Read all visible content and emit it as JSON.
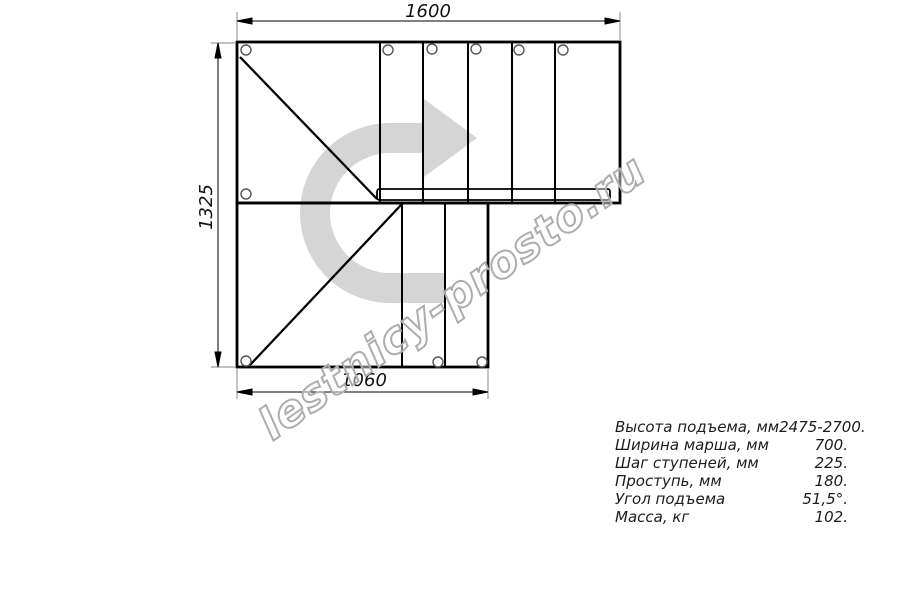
{
  "drawing": {
    "title_hint": "L-shaped staircase plan view",
    "dim_top": "1600",
    "dim_left": "1325",
    "dim_bottom": "1060",
    "watermark": "lestnicy-prosto.ru",
    "direction_arrow": "u-turn-arrow-pointing-right"
  },
  "specs": {
    "rows": [
      {
        "label": "Высота подъема, мм",
        "value": "2475-2700."
      },
      {
        "label": "Ширина марша, мм",
        "value": "700."
      },
      {
        "label": "Шаг ступеней, мм",
        "value": "225."
      },
      {
        "label": "Проступь, мм",
        "value": "180."
      },
      {
        "label": "Угол подъема",
        "value": "51,5°."
      },
      {
        "label": "Масса, кг",
        "value": "102."
      }
    ]
  },
  "colors": {
    "line": "#000000",
    "extension_line": "#9c9c9c",
    "circle_stroke": "#555555",
    "arrow_fill": "#d5d5d5",
    "watermark_stroke": "#adadad",
    "background": "#ffffff"
  }
}
